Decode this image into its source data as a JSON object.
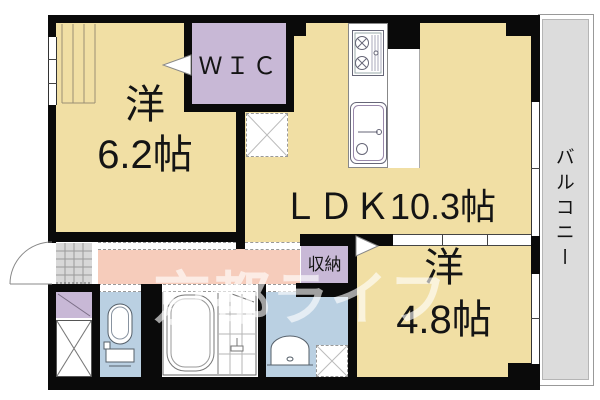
{
  "floorplan": {
    "watermark": "京都ライフ",
    "rooms": {
      "bedroom1": {
        "name": "洋",
        "size": "6.2帖"
      },
      "wic": {
        "label": "ＷＩＣ"
      },
      "ldk": {
        "label": "ＬＤＫ10.3帖"
      },
      "storage": {
        "label": "収納"
      },
      "bedroom2": {
        "name": "洋",
        "size": "4.8帖"
      },
      "balcony": {
        "label": "バルコニー"
      }
    },
    "colors": {
      "room_yellow": "#F1DFA4",
      "closet_purple": "#C8B8D6",
      "hallway_pink": "#F6CCBB",
      "wet_area_blue": "#BAD0E2",
      "balcony_gray": "#DCDCDC",
      "genkan_gray": "#D8D8D8",
      "wall_black": "#0A0A0A",
      "watermark_white": "#FFFFFF"
    }
  }
}
